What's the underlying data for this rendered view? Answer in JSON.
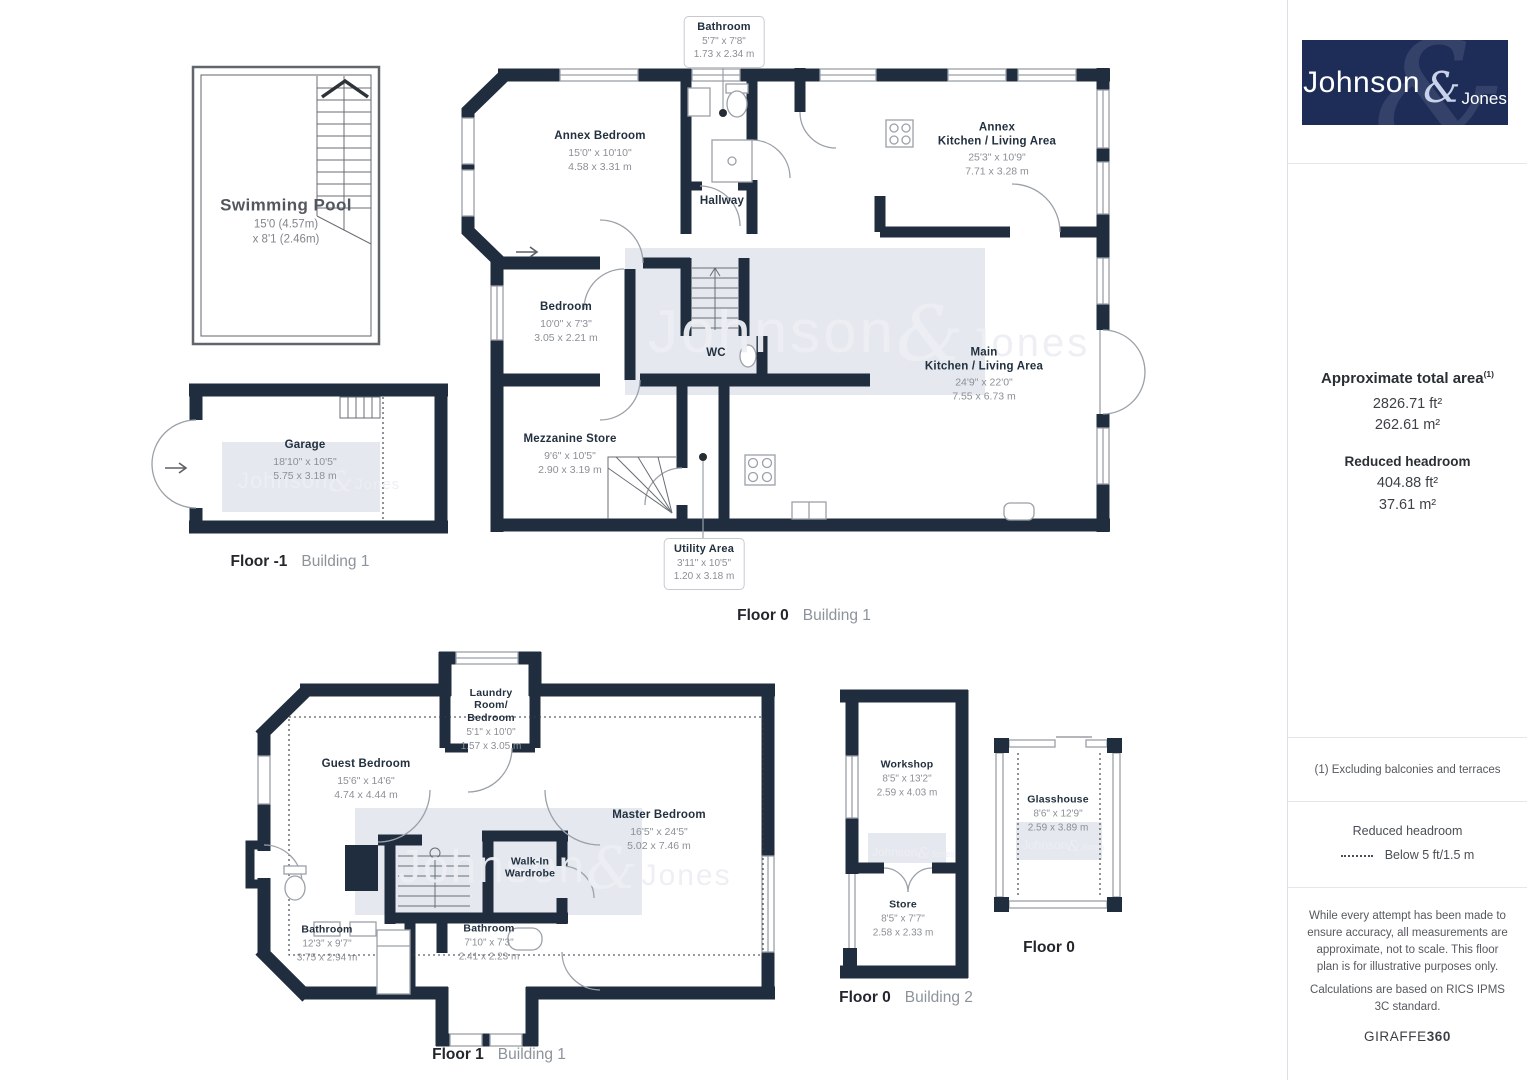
{
  "branding": {
    "logo": {
      "primary": "Johnson",
      "amp": "&",
      "secondary": "Jones"
    },
    "watermark": {
      "primary": "Johnson",
      "amp": "&",
      "secondary": "Jones"
    },
    "giraffe": {
      "normal": "GIRAFFE",
      "bold": "360"
    }
  },
  "colors": {
    "wall": "#1f2d3e",
    "logo_background": "#1e2c58",
    "watermark_background": "#e5e8ee",
    "room_name_text": "#22303f",
    "dimension_text": "#8b9097"
  },
  "sidebar": {
    "total_area": {
      "title": "Approximate total area",
      "sup": "(1)",
      "ft": "2826.71 ft²",
      "m": "262.61 m²"
    },
    "reduced_headroom": {
      "title": "Reduced headroom",
      "ft": "404.88 ft²",
      "m": "37.61 m²"
    },
    "footnote": "(1) Excluding balconies and terraces",
    "legend": {
      "title": "Reduced headroom",
      "label": "Below 5 ft/1.5 m"
    },
    "disclaimer_1": "While every attempt has been made to ensure accuracy, all measurements are approximate, not to scale. This floor plan is for illustrative purposes only.",
    "disclaimer_2": "Calculations are based on RICS IPMS 3C standard."
  },
  "floor_labels": {
    "floor_minus1_b1": {
      "floor": "Floor -1",
      "building": "Building 1"
    },
    "floor0_b1": {
      "floor": "Floor 0",
      "building": "Building 1"
    },
    "floor1_b1": {
      "floor": "Floor 1",
      "building": "Building 1"
    },
    "floor0_b2": {
      "floor": "Floor 0",
      "building": "Building 2"
    },
    "floor0_glasshouse": {
      "floor": "Floor 0",
      "building": ""
    }
  },
  "rooms": {
    "swimming_pool": {
      "name": "Swimming Pool",
      "dims": "15'0 (4.57m)\nx 8'1 (2.46m)"
    },
    "garage": {
      "name": "Garage",
      "dims": "18'10\" x 10'5\"\n5.75 x 3.18 m"
    },
    "bathroom_annex": {
      "name": "Bathroom",
      "dims": "5'7\" x 7'8\"\n1.73 x 2.34 m"
    },
    "annex_bedroom": {
      "name": "Annex Bedroom",
      "dims": "15'0\" x 10'10\"\n4.58 x 3.31 m"
    },
    "hallway": {
      "name": "Hallway"
    },
    "annex_kitchen": {
      "name": "Annex\nKitchen / Living Area",
      "dims": "25'3\" x 10'9\"\n7.71 x 3.28 m"
    },
    "bedroom": {
      "name": "Bedroom",
      "dims": "10'0\" x 7'3\"\n3.05 x 2.21 m"
    },
    "wc": {
      "name": "WC"
    },
    "main_kitchen": {
      "name": "Main\nKitchen / Living Area",
      "dims": "24'9\" x 22'0\"\n7.55 x 6.73 m"
    },
    "mezzanine_store": {
      "name": "Mezzanine Store",
      "dims": "9'6\" x 10'5\"\n2.90 x 3.19 m"
    },
    "utility_area": {
      "name": "Utility Area",
      "dims": "3'11\" x 10'5\"\n1.20 x 3.18 m"
    },
    "laundry_room": {
      "name": "Laundry\nRoom/\nBedroom",
      "dims": "5'1\" x 10'0\"\n1.57 x 3.05 m"
    },
    "guest_bedroom": {
      "name": "Guest Bedroom",
      "dims": "15'6\" x 14'6\"\n4.74 x 4.44 m"
    },
    "master_bedroom": {
      "name": "Master Bedroom",
      "dims": "16'5\" x 24'5\"\n5.02 x 7.46 m"
    },
    "walk_in_wardrobe": {
      "name": "Walk-In\nWardrobe"
    },
    "bathroom_1": {
      "name": "Bathroom",
      "dims": "12'3\" x 9'7\"\n3.75 x 2.94 m"
    },
    "bathroom_2": {
      "name": "Bathroom",
      "dims": "7'10\" x 7'3\"\n2.41 x 2.23 m"
    },
    "workshop": {
      "name": "Workshop",
      "dims": "8'5\" x 13'2\"\n2.59 x 4.03 m"
    },
    "store": {
      "name": "Store",
      "dims": "8'5\" x 7'7\"\n2.58 x 2.33 m"
    },
    "glasshouse": {
      "name": "Glasshouse",
      "dims": "8'6\" x 12'9\"\n2.59 x 3.89 m"
    }
  }
}
